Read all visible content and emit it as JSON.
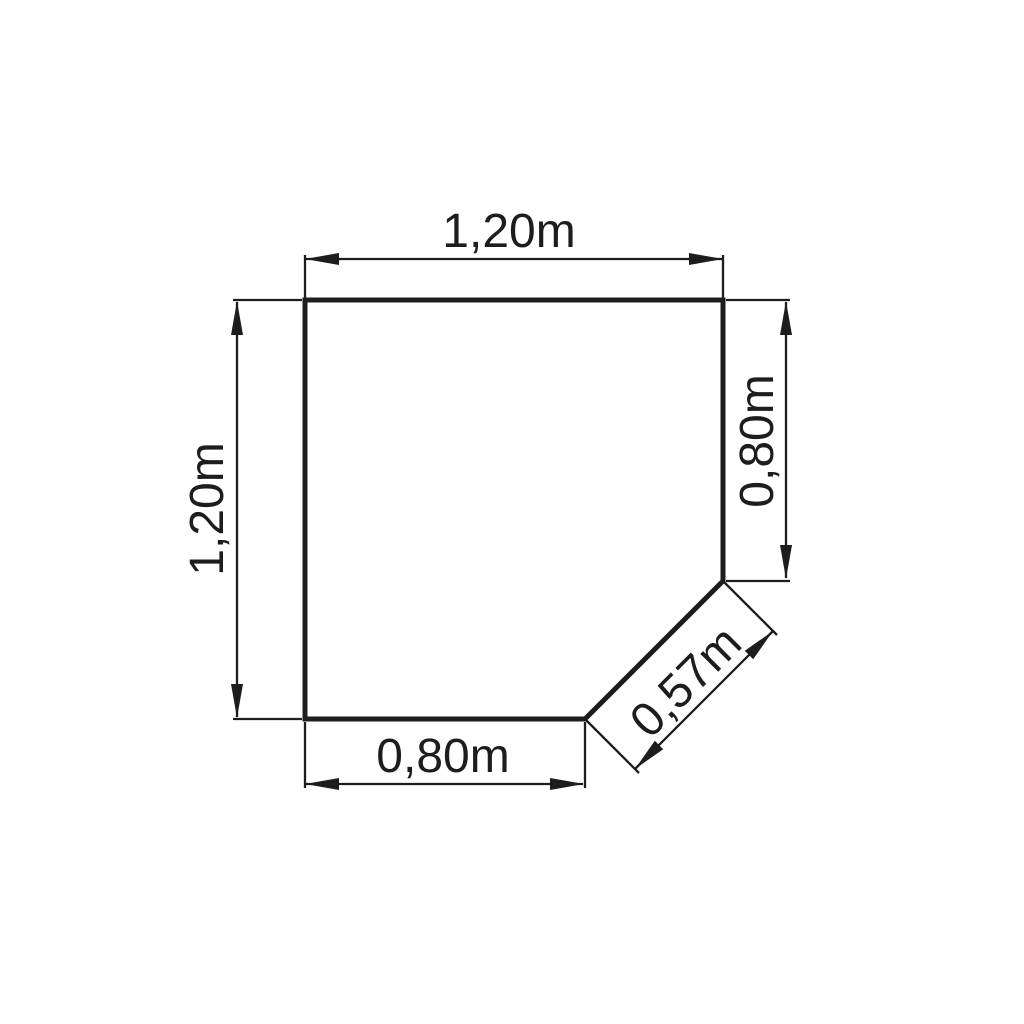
{
  "drawing": {
    "type": "technical-plan-chamfered-square",
    "background_color": "#ffffff",
    "line_color": "#1d1d1b",
    "dimensions": {
      "top": "1,20m",
      "left": "1,20m",
      "right": "0,80m",
      "bottom": "0,80m",
      "diagonal": "0,57m"
    }
  }
}
